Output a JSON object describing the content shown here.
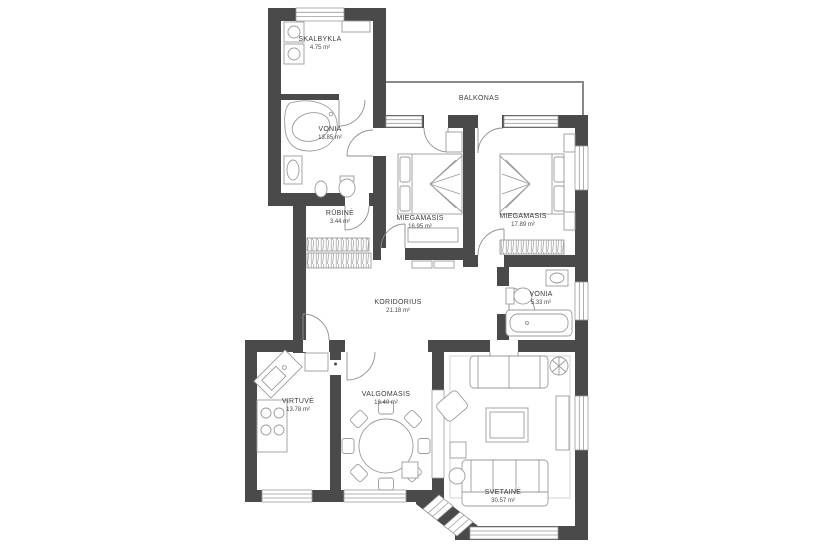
{
  "plan": {
    "type": "apartment-floor-plan",
    "wall_color": "#4a4a4a",
    "furniture_color": "#9b9b9b",
    "label_color": "#3b3b3b",
    "background_color": "#ffffff",
    "rooms": [
      {
        "id": "skalbykla",
        "name": "SKALBYKLA",
        "area": "4.75 m²"
      },
      {
        "id": "vonia-1",
        "name": "VONIA",
        "area": "13.85 m²"
      },
      {
        "id": "rubine",
        "name": "RŪBINĖ",
        "area": "3.44 m²"
      },
      {
        "id": "miegamasis-1",
        "name": "MIEGAMASIS",
        "area": "16.95 m²"
      },
      {
        "id": "miegamasis-2",
        "name": "MIEGAMASIS",
        "area": "17.89 m²"
      },
      {
        "id": "balkonas",
        "name": "BALKONAS",
        "area": ""
      },
      {
        "id": "koridorius",
        "name": "KORIDORIUS",
        "area": "21.18 m²"
      },
      {
        "id": "vonia-2",
        "name": "VONIA",
        "area": "5.33 m²"
      },
      {
        "id": "virtuve",
        "name": "VIRTUVĖ",
        "area": "13.78 m²"
      },
      {
        "id": "valgomasis",
        "name": "VALGOMASIS",
        "area": "18.40 m²"
      },
      {
        "id": "svetaine",
        "name": "SVETAINĖ",
        "area": "30.57 m²"
      }
    ]
  }
}
